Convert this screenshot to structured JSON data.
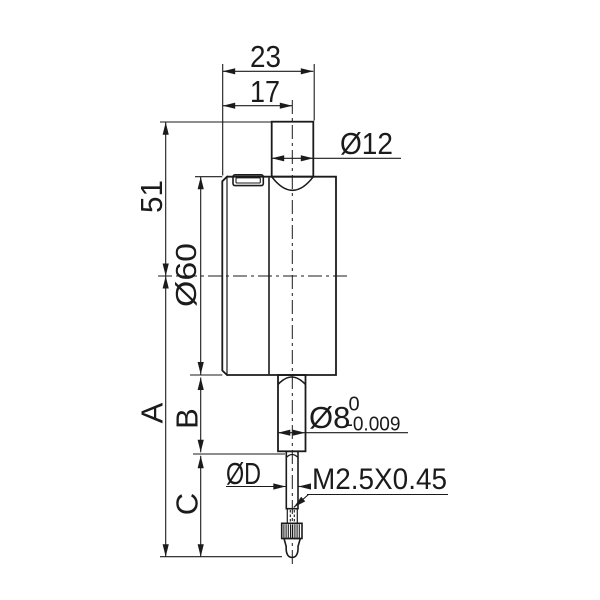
{
  "drawing": {
    "labels": {
      "top_width": "23",
      "inner_width": "17",
      "top_stem_diameter": "Ø12",
      "upper_height": "51",
      "body_diameter": "Ø60",
      "overall_length": "A",
      "stem_length": "B",
      "tip_length": "C",
      "stem_diameter": "Ø8",
      "stem_tol_upper": "0",
      "stem_tol_lower": "-0.009",
      "contact_diameter": "ØD",
      "thread": "M2.5X0.45"
    },
    "colors": {
      "part_fill": "#d5d5d5",
      "bezel_fill": "#bcbcbc",
      "detail_fill": "#ffffff",
      "line": "#1b1b1b",
      "background": "#ffffff"
    }
  }
}
